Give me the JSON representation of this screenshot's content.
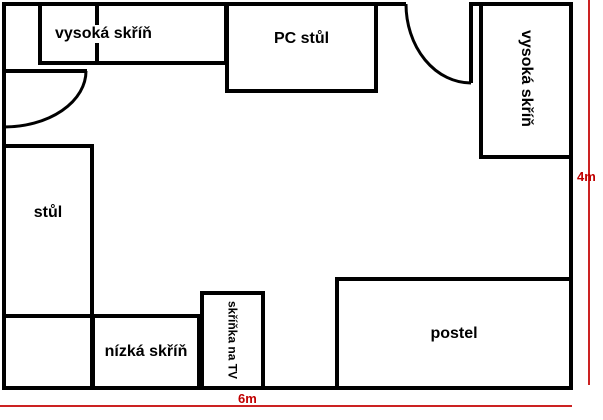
{
  "diagram": {
    "type": "room-floor-plan",
    "colors": {
      "wall": "#000000",
      "background": "#ffffff",
      "dimension_line": "#cc2222",
      "dimension_text": "#c00000"
    },
    "furniture": [
      {
        "id": "wardrobe-top",
        "label": "vysoká skříň"
      },
      {
        "id": "pc-desk",
        "label": "PC stůl"
      },
      {
        "id": "wardrobe-right",
        "label": "vysoká skříň"
      },
      {
        "id": "desk",
        "label": "stůl"
      },
      {
        "id": "low-cabinet",
        "label": "nízká skříň"
      },
      {
        "id": "tv-cabinet",
        "label": "skříňka na TV"
      },
      {
        "id": "bed",
        "label": "postel"
      }
    ],
    "dimensions": {
      "width_label": "6m",
      "height_label": "4m"
    },
    "doors": [
      {
        "id": "door-left",
        "wall": "left"
      },
      {
        "id": "door-top",
        "wall": "top"
      }
    ]
  }
}
